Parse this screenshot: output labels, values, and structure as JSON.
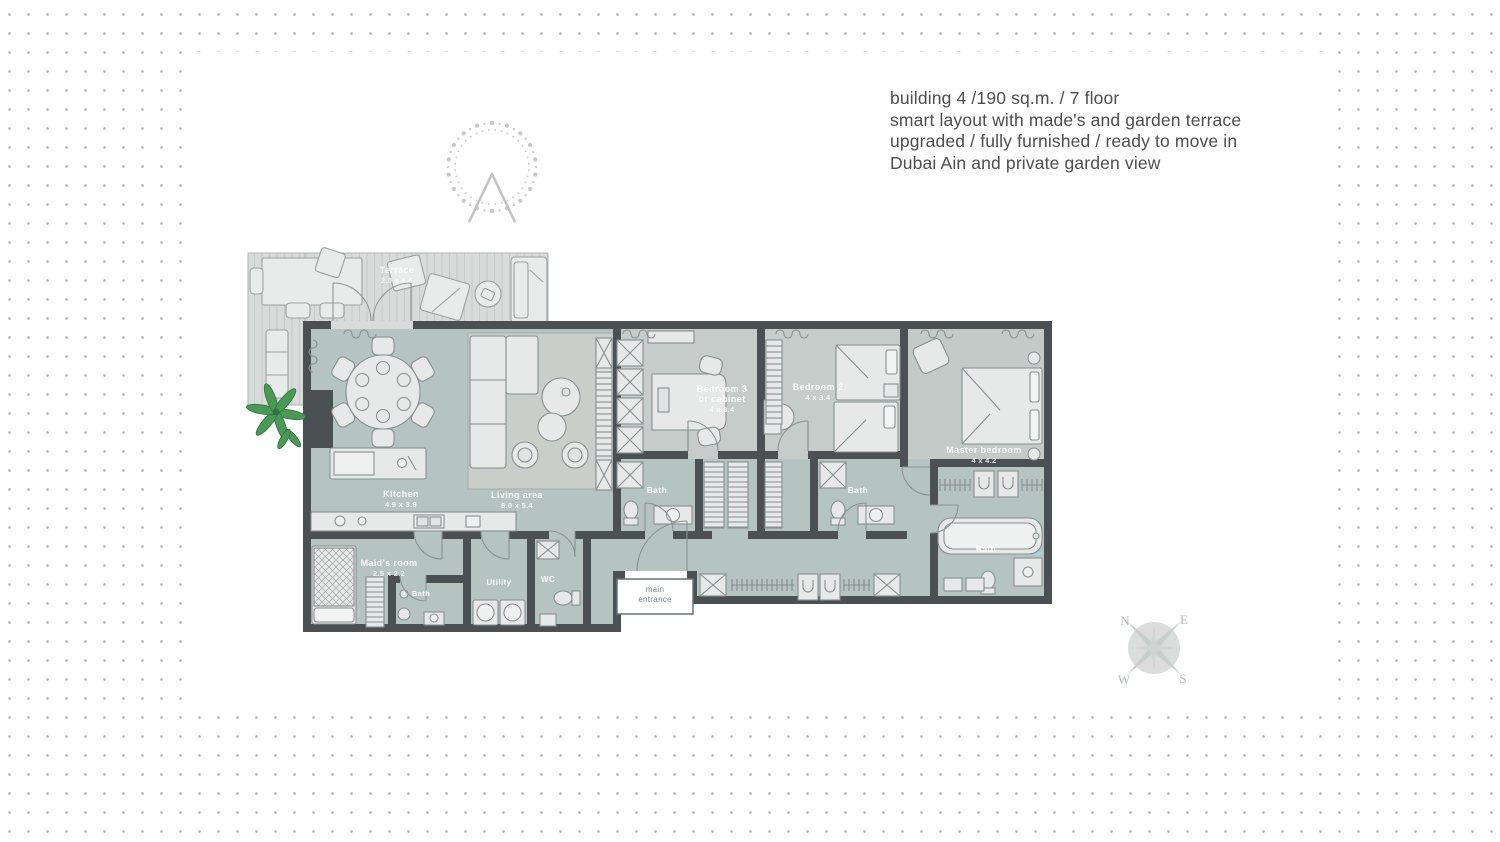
{
  "title": {
    "lines": [
      "building 4 /190 sq.m. / 7 floor",
      "smart layout with made's and garden terrace",
      "upgraded / fully furnished / ready to move in",
      "Dubai Ain and private garden view"
    ]
  },
  "plan": {
    "terrace": {
      "name": "Terrace",
      "dims": "2.0 x 6.6"
    },
    "kitchen": {
      "name": "Kitchen",
      "dims": "4.9 x 3.9"
    },
    "living": {
      "name": "Living area",
      "dims": "8.0 x 5.4"
    },
    "bedroom3": {
      "line1": "Bedroom 3",
      "line2": "or cabinet",
      "dims": "4 x 3.4"
    },
    "bedroom2": {
      "name": "Bedroom 2",
      "dims": "4 x 3.4"
    },
    "master": {
      "name": "Master bedroom",
      "dims": "4 x 4.2"
    },
    "maids": {
      "name": "Maid's room",
      "dims": "2.5 x 2.2"
    },
    "bath": "Bath",
    "utility": "Utility",
    "wc": "WC",
    "entrance": {
      "line1": "main",
      "line2": "entrance"
    }
  },
  "compass": {
    "n": "N",
    "e": "E",
    "s": "S",
    "w": "W"
  },
  "colors": {
    "wall": "#4b5053",
    "floor": "#b5c4c0",
    "carpet": "#c6ccc9",
    "rug": "#c9cecb",
    "deck": "#d8dbd9",
    "window_blue": "#a2d1ea",
    "plant_green": "#4a9a55",
    "text_gray": "#4e4e4f",
    "dot_gray": "#b4b4b4",
    "logo_gray": "#c7c7c7"
  }
}
